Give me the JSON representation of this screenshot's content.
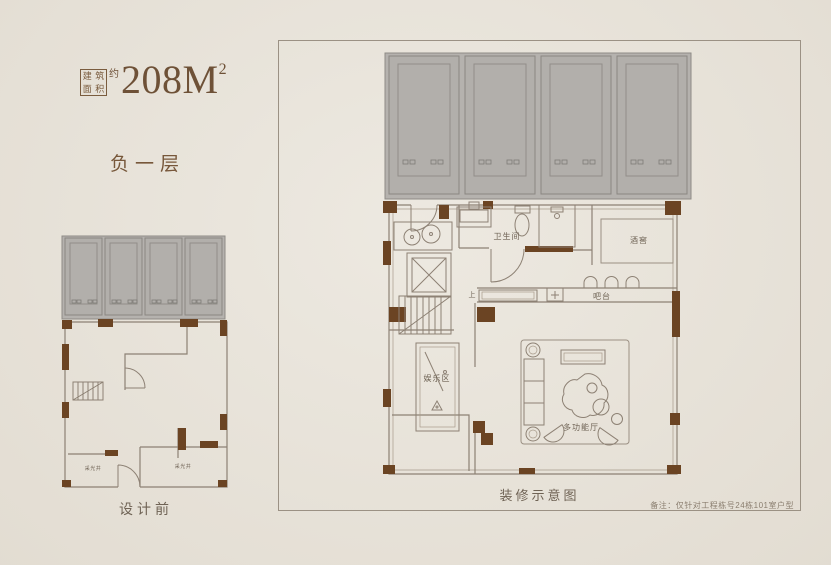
{
  "header": {
    "area_box_chars": [
      "建",
      "筑",
      "面",
      "积"
    ],
    "approx_label": "约",
    "area_value": "208M",
    "area_sup": "2",
    "floor_label": "负一层"
  },
  "left_plan": {
    "caption": "设计前",
    "labels": {
      "lightwell_left": "采光井",
      "lightwell_right": "采光井"
    }
  },
  "right_plan": {
    "caption": "装修示意图",
    "note": "备注：仅针对工程栋号24栋101室户型",
    "rooms": {
      "bathroom": "卫生间",
      "wine_cellar": "酒窖",
      "bar": "吧台",
      "entertainment": "娱乐区",
      "multi_function_hall": "多功能厅",
      "stairs_up": "上"
    }
  },
  "colors": {
    "background": "#e9e4da",
    "title_brown": "#6e5137",
    "wall_dark": "#6b4423",
    "plan_line": "#8d8174",
    "parking_gray": "#b5b2ae",
    "panel_border": "#9b9184"
  }
}
